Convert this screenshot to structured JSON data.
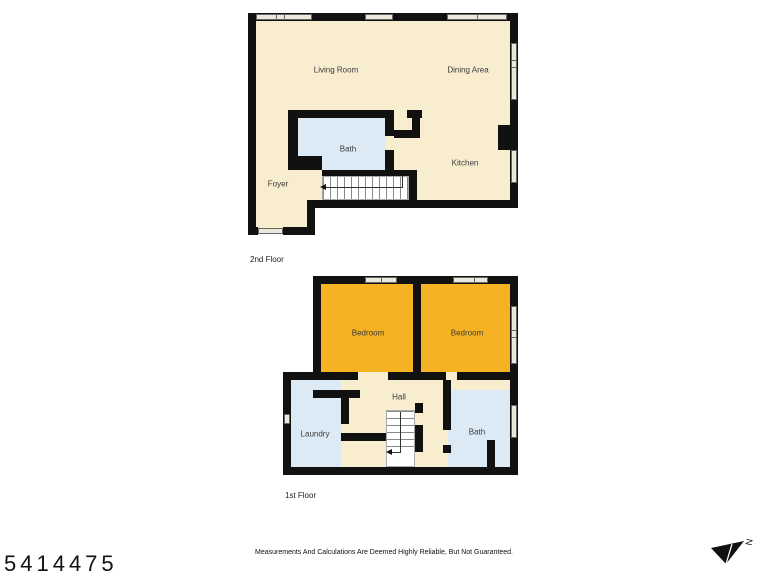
{
  "floor2": {
    "caption": "2nd Floor",
    "rooms": [
      {
        "label": "Living Room"
      },
      {
        "label": "Dining Area"
      },
      {
        "label": "Bath"
      },
      {
        "label": "Kitchen"
      },
      {
        "label": "Foyer"
      }
    ]
  },
  "floor1": {
    "caption": "1st Floor",
    "rooms": [
      {
        "label": "Bedroom"
      },
      {
        "label": "Bedroom"
      },
      {
        "label": "Hall"
      },
      {
        "label": "Laundry"
      },
      {
        "label": "Bath"
      }
    ]
  },
  "footer": {
    "listing_id": "5414475",
    "disclaimer": "Measurements And Calculations Are Deemed Highly Reliable, But Not Guaranteed.",
    "compass_label": "N"
  },
  "colors": {
    "wall": "#111111",
    "floor": "#f9edd0",
    "bedroom": "#f5b324",
    "bath": "#dceaf6",
    "stairs": "#ffffff"
  }
}
